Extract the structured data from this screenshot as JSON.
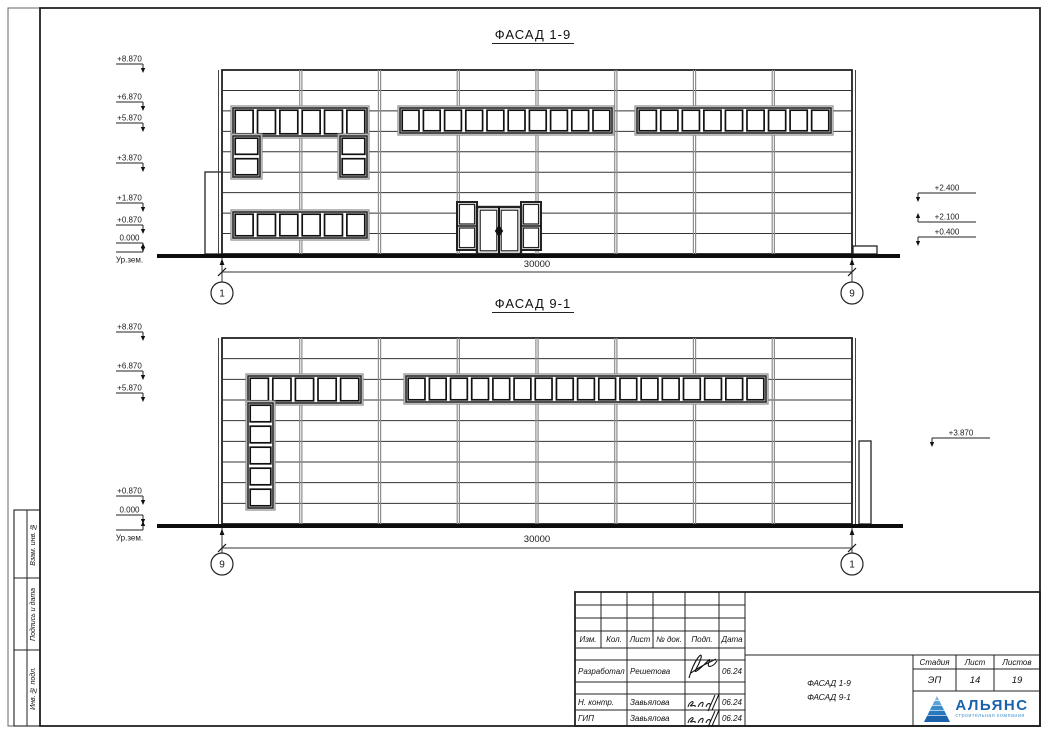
{
  "sheet": {
    "width": 1047,
    "height": 733
  },
  "sidebar": {
    "labels": [
      "Взам. инв. №",
      "Подпись и дата",
      "Инв. № подл."
    ]
  },
  "facades": [
    {
      "title": "ФАСАД 1-9",
      "building": {
        "x": 222,
        "y": 70,
        "w": 630,
        "h": 184,
        "bands": 9
      },
      "mullions": [
        300.8,
        379.5,
        458.3,
        537,
        615.8,
        694.5,
        773.3
      ],
      "annexes": [
        {
          "x": 205,
          "y": 172,
          "w": 17,
          "h": 82
        }
      ],
      "stoops": [
        {
          "x": 853,
          "y": 246,
          "w": 24,
          "h": 8
        }
      ],
      "windows": [
        {
          "x": 233,
          "y": 108,
          "w": 134,
          "h": 28,
          "cols": 6,
          "rows": 1
        },
        {
          "x": 233,
          "y": 136,
          "w": 27,
          "h": 41,
          "cols": 1,
          "rows": 2
        },
        {
          "x": 340,
          "y": 136,
          "w": 27,
          "h": 41,
          "cols": 1,
          "rows": 2
        },
        {
          "x": 400,
          "y": 108,
          "w": 212,
          "h": 25,
          "cols": 10,
          "rows": 1
        },
        {
          "x": 637,
          "y": 108,
          "w": 194,
          "h": 25,
          "cols": 9,
          "rows": 1
        },
        {
          "x": 233,
          "y": 212,
          "w": 134,
          "h": 26,
          "cols": 6,
          "rows": 1
        }
      ],
      "door": {
        "x": 477,
        "y": 207,
        "w": 44,
        "h": 47,
        "sides": [
          {
            "x": 457,
            "y": 202,
            "w": 20,
            "h": 48
          },
          {
            "x": 521,
            "y": 202,
            "w": 20,
            "h": 48
          }
        ],
        "sill": {
          "x": 467,
          "y": 254,
          "w": 66,
          "h": 3.5
        }
      },
      "ground": {
        "x1": 157,
        "x2": 900,
        "y": 256
      },
      "dim": {
        "label": "30000",
        "y": 272,
        "text_y": 267,
        "circle_y": 293,
        "left_axis": "1",
        "right_axis": "9"
      },
      "marks_left": [
        {
          "v": "+8.870",
          "y": 64
        },
        {
          "v": "+6.870",
          "y": 102
        },
        {
          "v": "+5.870",
          "y": 123
        },
        {
          "v": "+3.870",
          "y": 163
        },
        {
          "v": "+1.870",
          "y": 203
        },
        {
          "v": "+0.870",
          "y": 225
        },
        {
          "v": "0.000",
          "y": 243
        },
        {
          "v": "Ур.зем.",
          "y": 252,
          "below": true,
          "up": true
        }
      ],
      "marks_right": [
        {
          "v": "+2.400",
          "y": 193,
          "x": 918
        },
        {
          "v": "+2.100",
          "y": 222,
          "x": 918,
          "up": true
        },
        {
          "v": "+0.400",
          "y": 237,
          "x": 918
        }
      ]
    },
    {
      "title": "ФАСАД 9-1",
      "building": {
        "x": 222,
        "y": 338,
        "w": 630,
        "h": 186,
        "bands": 9
      },
      "mullions": [
        300.8,
        379.5,
        458.3,
        537,
        615.8,
        694.5,
        773.3
      ],
      "annexes": [
        {
          "x": 859,
          "y": 441,
          "w": 12,
          "h": 83
        }
      ],
      "stoops": [],
      "windows": [
        {
          "x": 248,
          "y": 376,
          "w": 113,
          "h": 27,
          "cols": 5,
          "rows": 1
        },
        {
          "x": 248,
          "y": 403,
          "w": 25,
          "h": 105,
          "cols": 1,
          "rows": 5
        },
        {
          "x": 406,
          "y": 376,
          "w": 360,
          "h": 26,
          "cols": 17,
          "rows": 1
        }
      ],
      "ground": {
        "x1": 157,
        "x2": 903,
        "y": 526
      },
      "dim": {
        "label": "30000",
        "y": 548,
        "text_y": 542,
        "circle_y": 564,
        "left_axis": "9",
        "right_axis": "1"
      },
      "marks_left": [
        {
          "v": "+8.870",
          "y": 332
        },
        {
          "v": "+6.870",
          "y": 371
        },
        {
          "v": "+5.870",
          "y": 393
        },
        {
          "v": "+0.870",
          "y": 496
        },
        {
          "v": "0.000",
          "y": 515
        },
        {
          "v": "Ур.зем.",
          "y": 530,
          "below": true,
          "up": true
        }
      ],
      "marks_right": [
        {
          "v": "+3.870",
          "y": 438,
          "x": 932
        }
      ]
    }
  ],
  "titleblock": {
    "cols": [
      "Изм.",
      "Кол.",
      "Лист",
      "№ док.",
      "Подп.",
      "Дата"
    ],
    "sign_rows": [
      {
        "role": "Разработал",
        "name": "Решетова",
        "date": "06.24"
      },
      {
        "role": "Н. контр.",
        "name": "Завьялова",
        "date": "06.24"
      },
      {
        "role": "ГИП",
        "name": "Завьялова",
        "date": "06.24"
      }
    ],
    "stage": {
      "headers": [
        "Стадия",
        "Лист",
        "Листов"
      ],
      "values": [
        "ЭП",
        "14",
        "19"
      ]
    },
    "doc_title_line1": "ФАСАД 1-9",
    "doc_title_line2": "ФАСАД 9-1",
    "logo": {
      "name": "АЛЬЯНС",
      "subtitle": "строительная компания",
      "color": "#1a63ab",
      "subtitle_color": "#4f9bd5",
      "pyramid_color": "#2a7cbd"
    }
  }
}
